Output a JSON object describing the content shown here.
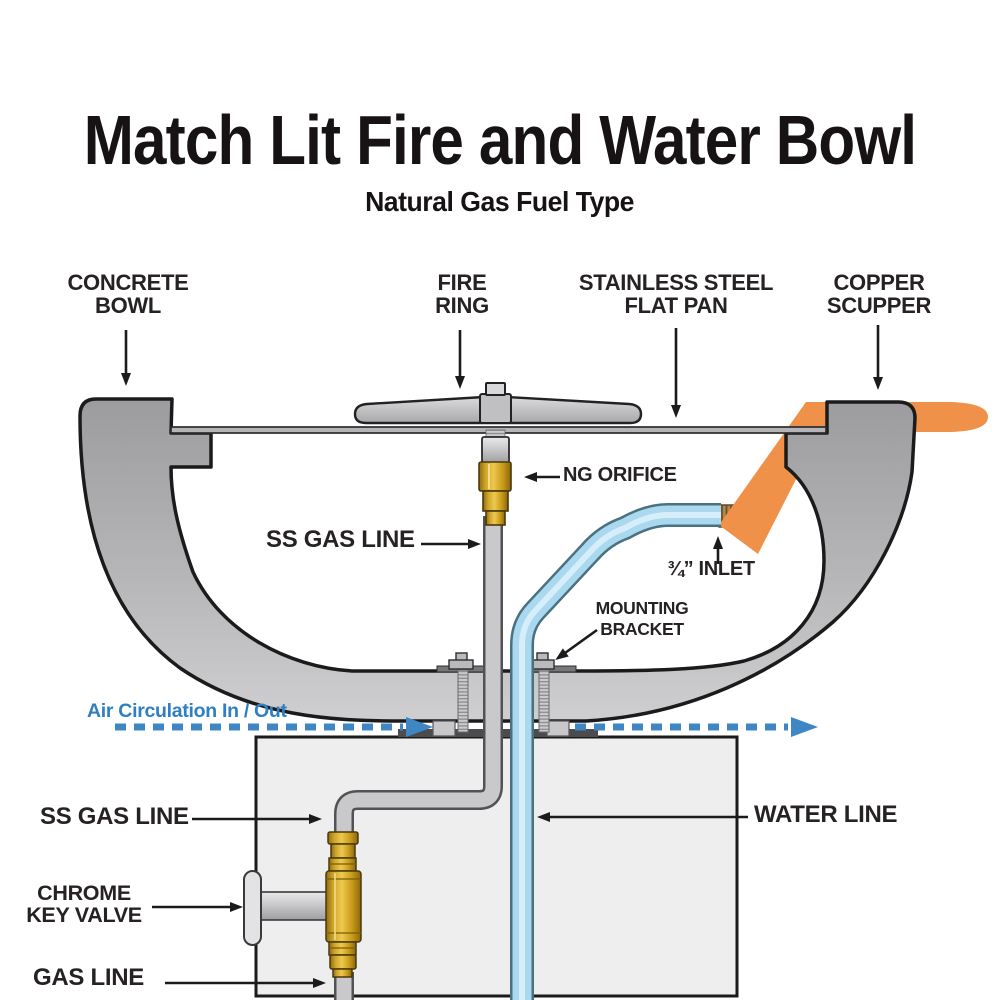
{
  "title": "Match Lit Fire and Water Bowl",
  "subtitle": "Natural Gas Fuel Type",
  "callouts": {
    "concrete_bowl": {
      "lines": [
        "CONCRETE",
        "BOWL"
      ]
    },
    "fire_ring": {
      "lines": [
        "FIRE",
        "RING"
      ]
    },
    "flat_pan": {
      "lines": [
        "STAINLESS STEEL",
        "FLAT PAN"
      ]
    },
    "copper_scupper": {
      "lines": [
        "COPPER",
        "SCUPPER"
      ]
    },
    "ng_orifice": {
      "lines": [
        "NG ORIFICE"
      ]
    },
    "ss_gas_line_upper": {
      "lines": [
        "SS GAS LINE"
      ]
    },
    "inlet": {
      "lines": [
        "¾” INLET"
      ]
    },
    "mounting_bracket": {
      "lines": [
        "MOUNTING",
        "BRACKET"
      ]
    },
    "air_circulation": {
      "lines": [
        "Air Circulation In / Out"
      ]
    },
    "ss_gas_line_lower": {
      "lines": [
        "SS GAS LINE"
      ]
    },
    "water_line": {
      "lines": [
        "WATER LINE"
      ]
    },
    "chrome_key_valve": {
      "lines": [
        "CHROME",
        "KEY VALVE"
      ]
    },
    "gas_line": {
      "lines": [
        "GAS LINE"
      ]
    }
  },
  "colors": {
    "label_text": "#262223",
    "air_flow_blue": "#3e86c4",
    "air_label_blue": "#2f7fc1",
    "copper_orange": "#f0914a",
    "brass_gold": "#d9a51d",
    "water_pipe_blue": "#a9d8ef",
    "bowl_gray": "#b4b4b6",
    "pedestal_gray": "#eeeeef"
  }
}
